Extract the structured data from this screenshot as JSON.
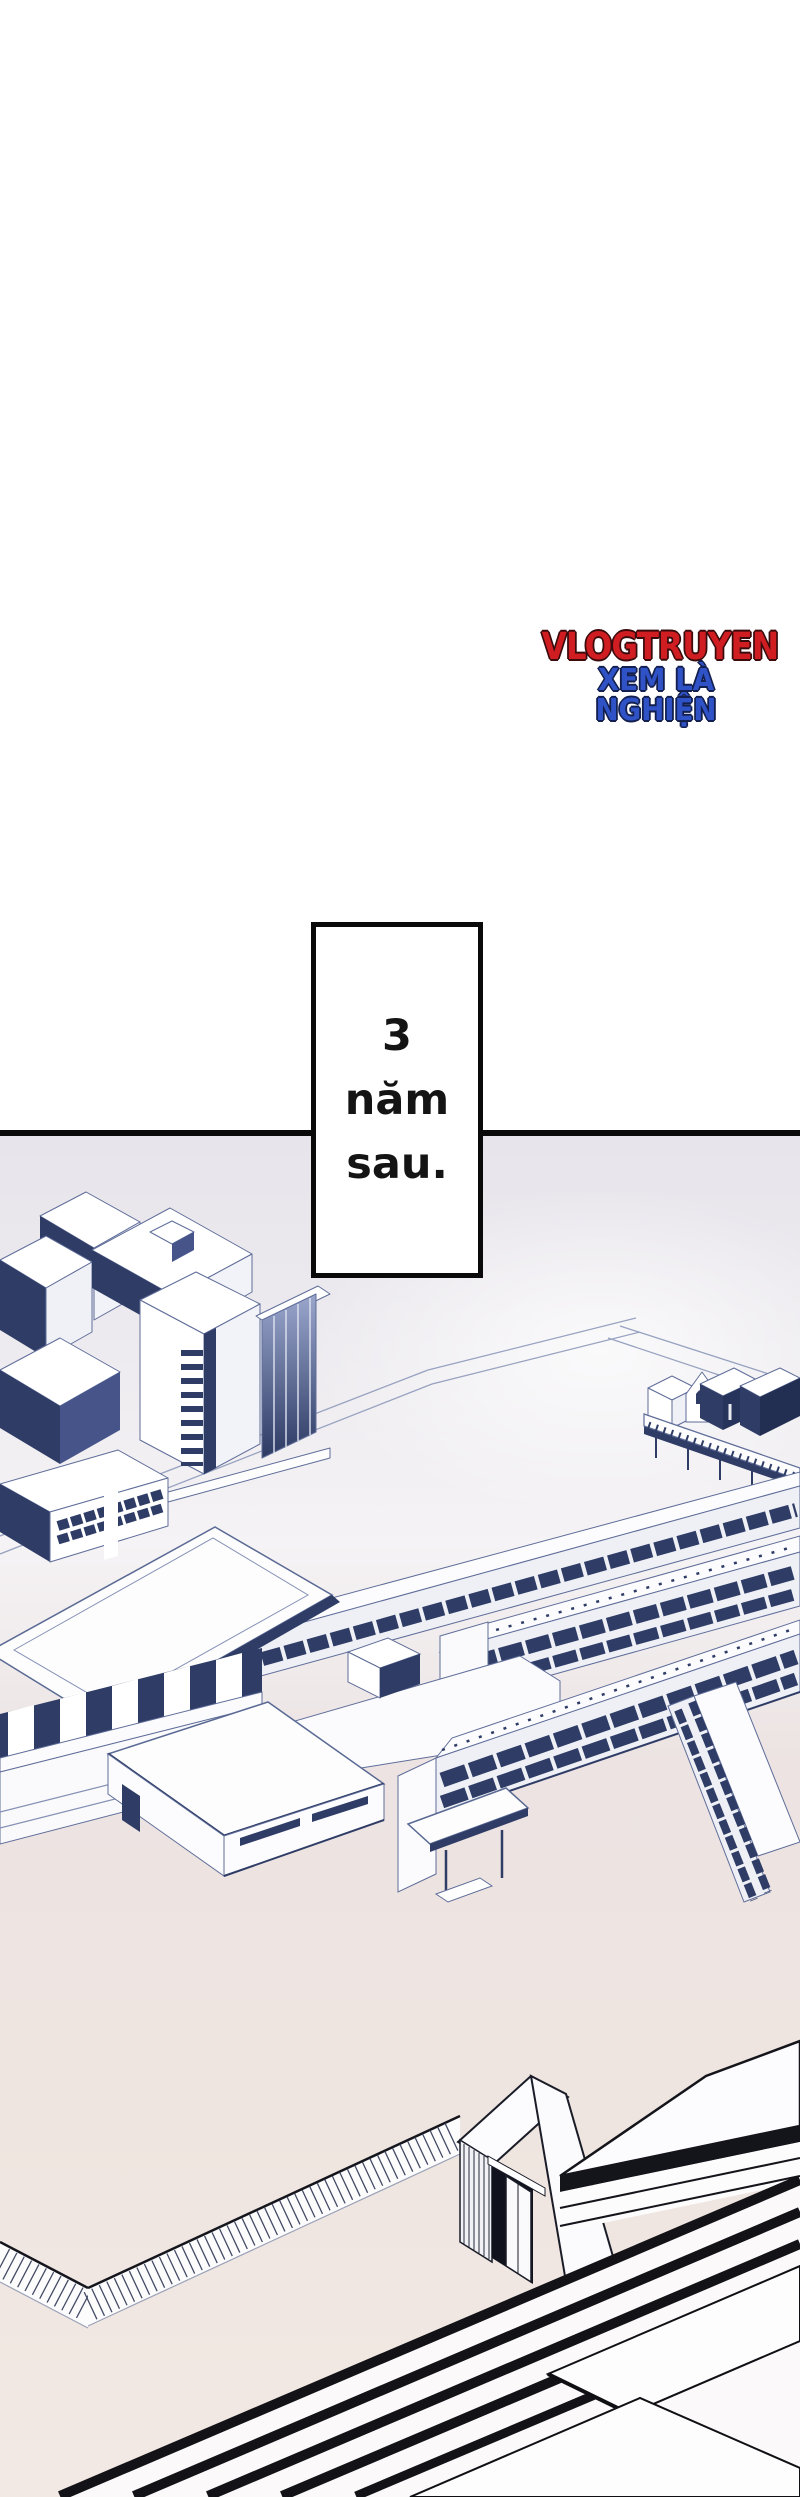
{
  "watermark": {
    "line1": "VLOGTRUYEN",
    "line2": "XEM LÀ NGHIỆN",
    "color_line1": "#d01d22",
    "color_line2": "#2f52c6"
  },
  "caption_box": {
    "lines": [
      "3",
      "năm",
      "sau."
    ],
    "text": "3 năm sau."
  },
  "illustration": {
    "alt": "Aerial isometric line-art of a school campus: office buildings at top left, small houses and guard rails at the right, a gymnasium and multi-story school wings with dark window bands in the center, a schoolyard bordered by a picket fence, a gatehouse with a dark doorway, and a large striped-roof building in the foreground",
    "palette": {
      "outline_blue": "#5f6d99",
      "navy": "#2e3c66",
      "sky_lavender": "#e7e4eb",
      "ground_pink": "#eee3de",
      "ink_black": "#121217",
      "white_face": "#fdfdfe"
    }
  }
}
